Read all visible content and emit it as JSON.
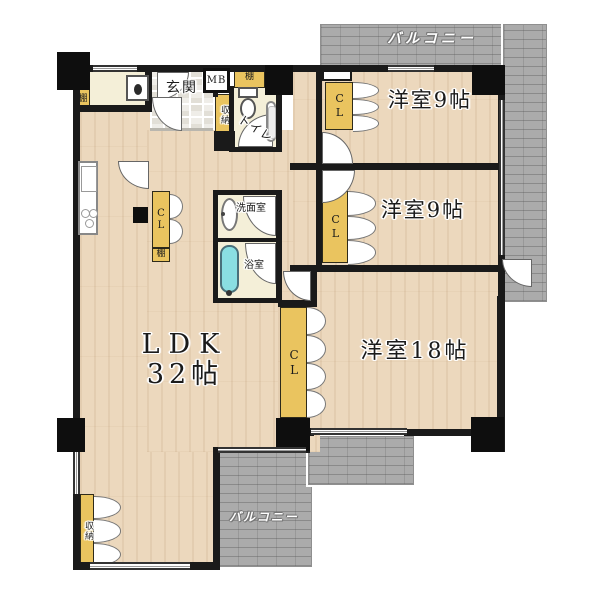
{
  "colors": {
    "wood": "#ecd8bd",
    "cream": "#f4efd8",
    "closet": "#eac45f",
    "balcony": "#ababab",
    "wall": "#1a1a1a",
    "tub": "#8adfe2"
  },
  "labels": {
    "balcony_top": "バルコニー",
    "balcony_bottom": "バルコニー",
    "entrance": "玄関",
    "mb": "MB",
    "toilet": "トイレ",
    "washroom": "洗面室",
    "bathroom": "浴室",
    "ldk_name": "LDK",
    "ldk_size": "32帖",
    "bedroom1": "洋室9帖",
    "bedroom2": "洋室9帖",
    "bedroom3": "洋室18帖",
    "closets": [
      "CL",
      "CL",
      "CL",
      "CL"
    ],
    "shelves": [
      "棚",
      "棚",
      "棚"
    ],
    "storages": [
      "収納",
      "収納"
    ]
  }
}
